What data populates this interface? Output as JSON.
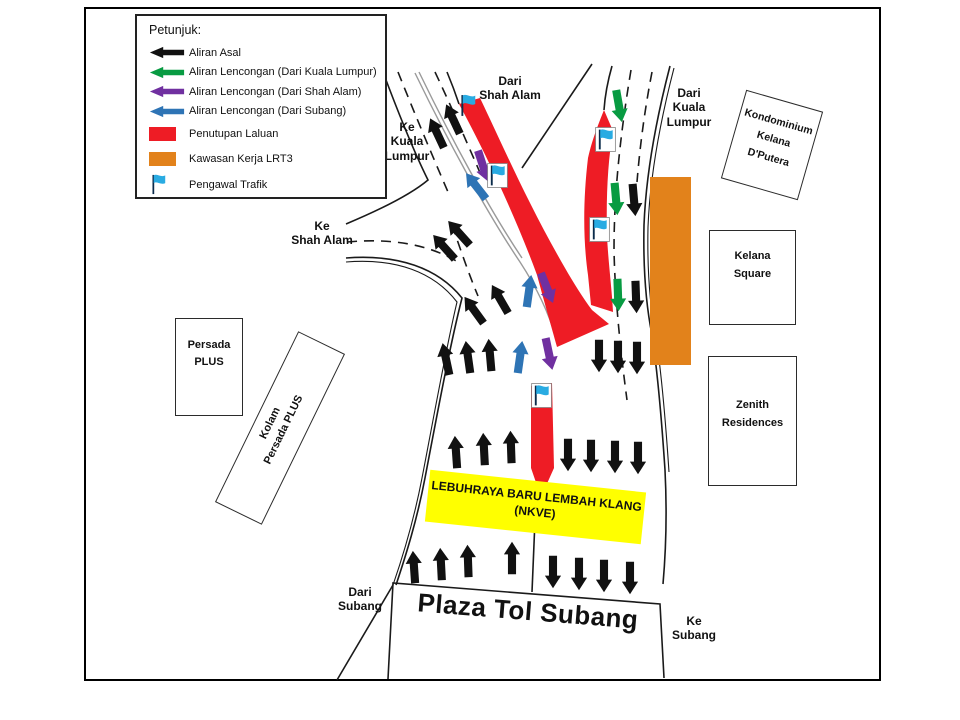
{
  "colors": {
    "red": "#EE1C25",
    "orange": "#E2821B",
    "yellow": "#FFFF00",
    "flag_blue": "#29ABE2",
    "road_line": "#1a1a1a"
  },
  "flow_colors": {
    "asal": "#111111",
    "lencongan_kl": "#089B42",
    "lencongan_shah_alam": "#7030A0",
    "lencongan_subang": "#2E74B5"
  },
  "legend": {
    "title": "Petunjuk:",
    "items": [
      {
        "label": "Aliran Asal",
        "swatch": "arrow",
        "flow": "asal"
      },
      {
        "label": "Aliran Lencongan (Dari Kuala Lumpur)",
        "swatch": "arrow",
        "flow": "lencongan_kl"
      },
      {
        "label": "Aliran Lencongan (Dari Shah Alam)",
        "swatch": "arrow",
        "flow": "lencongan_shah_alam"
      },
      {
        "label": "Aliran Lencongan (Dari Subang)",
        "swatch": "arrow",
        "flow": "lencongan_subang"
      },
      {
        "label": "Penutupan Laluan",
        "swatch": "rect",
        "color": "red"
      },
      {
        "label": "Kawasan Kerja LRT3",
        "swatch": "rect",
        "color": "orange"
      },
      {
        "label": "Pengawal Trafik",
        "swatch": "flag"
      }
    ]
  },
  "labels": {
    "dari_shah_alam": [
      "Dari",
      "Shah Alam"
    ],
    "dari_kuala_lumpur": [
      "Dari",
      "Kuala",
      "Lumpur"
    ],
    "ke_kuala_lumpur": [
      "Ke",
      "Kuala",
      "Lumpur"
    ],
    "ke_shah_alam": [
      "Ke",
      "Shah Alam"
    ],
    "dari_subang": [
      "Dari",
      "Subang"
    ],
    "ke_subang": [
      "Ke",
      "Subang"
    ]
  },
  "buildings": {
    "kondominium": [
      "Kondominium",
      "Kelana",
      "D'Putera"
    ],
    "kelana_square": [
      "Kelana",
      "Square"
    ],
    "zenith": [
      "Zenith",
      "Residences"
    ],
    "persada": [
      "Persada",
      "PLUS"
    ],
    "kolam": [
      "Kolam",
      "Persada PLUS"
    ]
  },
  "banner": [
    "LEBUHRAYA BARU LEMBAH KLANG",
    "(NKVE)"
  ],
  "plaza_label": "Plaza Tol Subang",
  "map": {
    "arrows": [
      {
        "x": 437,
        "y": 133,
        "rot": -25,
        "type": "asal"
      },
      {
        "x": 453,
        "y": 119,
        "rot": -25,
        "type": "asal"
      },
      {
        "x": 444,
        "y": 247,
        "rot": -42,
        "type": "asal"
      },
      {
        "x": 459,
        "y": 233,
        "rot": -42,
        "type": "asal"
      },
      {
        "x": 474,
        "y": 310,
        "rot": -36,
        "type": "asal"
      },
      {
        "x": 500,
        "y": 299,
        "rot": -30,
        "type": "asal"
      },
      {
        "x": 446,
        "y": 359,
        "rot": -12,
        "type": "asal"
      },
      {
        "x": 468,
        "y": 357,
        "rot": -8,
        "type": "asal"
      },
      {
        "x": 490,
        "y": 355,
        "rot": -5,
        "type": "asal"
      },
      {
        "x": 456,
        "y": 452,
        "rot": -4,
        "type": "asal"
      },
      {
        "x": 484,
        "y": 449,
        "rot": -3,
        "type": "asal"
      },
      {
        "x": 511,
        "y": 447,
        "rot": -2,
        "type": "asal"
      },
      {
        "x": 414,
        "y": 567,
        "rot": -4,
        "type": "asal"
      },
      {
        "x": 441,
        "y": 564,
        "rot": -3,
        "type": "asal"
      },
      {
        "x": 468,
        "y": 561,
        "rot": -2,
        "type": "asal"
      },
      {
        "x": 512,
        "y": 558,
        "rot": 0,
        "type": "asal"
      },
      {
        "x": 634,
        "y": 200,
        "rot": 175,
        "type": "asal"
      },
      {
        "x": 636,
        "y": 297,
        "rot": 178,
        "type": "asal"
      },
      {
        "x": 599,
        "y": 356,
        "rot": 180,
        "type": "asal"
      },
      {
        "x": 618,
        "y": 357,
        "rot": 180,
        "type": "asal"
      },
      {
        "x": 637,
        "y": 358,
        "rot": 180,
        "type": "asal"
      },
      {
        "x": 568,
        "y": 455,
        "rot": 180,
        "type": "asal"
      },
      {
        "x": 591,
        "y": 456,
        "rot": 180,
        "type": "asal"
      },
      {
        "x": 615,
        "y": 457,
        "rot": 180,
        "type": "asal"
      },
      {
        "x": 638,
        "y": 458,
        "rot": 180,
        "type": "asal"
      },
      {
        "x": 553,
        "y": 572,
        "rot": 180,
        "type": "asal"
      },
      {
        "x": 579,
        "y": 574,
        "rot": 180,
        "type": "asal"
      },
      {
        "x": 604,
        "y": 576,
        "rot": 180,
        "type": "asal"
      },
      {
        "x": 630,
        "y": 578,
        "rot": 180,
        "type": "asal"
      },
      {
        "x": 619,
        "y": 106,
        "rot": 170,
        "type": "lencongan_kl"
      },
      {
        "x": 616,
        "y": 199,
        "rot": 175,
        "type": "lencongan_kl"
      },
      {
        "x": 618,
        "y": 295,
        "rot": 178,
        "type": "lencongan_kl"
      },
      {
        "x": 483,
        "y": 166,
        "rot": 162,
        "type": "lencongan_shah_alam"
      },
      {
        "x": 547,
        "y": 288,
        "rot": 158,
        "type": "lencongan_shah_alam"
      },
      {
        "x": 549,
        "y": 354,
        "rot": 168,
        "type": "lencongan_shah_alam"
      },
      {
        "x": 476,
        "y": 186,
        "rot": -38,
        "type": "lencongan_subang"
      },
      {
        "x": 529,
        "y": 291,
        "rot": 8,
        "type": "lencongan_subang"
      },
      {
        "x": 520,
        "y": 357,
        "rot": 8,
        "type": "lencongan_subang"
      }
    ],
    "flags": [
      {
        "x": 458,
        "y": 93,
        "boxed": false
      },
      {
        "x": 487,
        "y": 163,
        "boxed": true
      },
      {
        "x": 595,
        "y": 127,
        "boxed": true
      },
      {
        "x": 589,
        "y": 217,
        "boxed": true
      },
      {
        "x": 531,
        "y": 383,
        "boxed": true
      }
    ]
  }
}
